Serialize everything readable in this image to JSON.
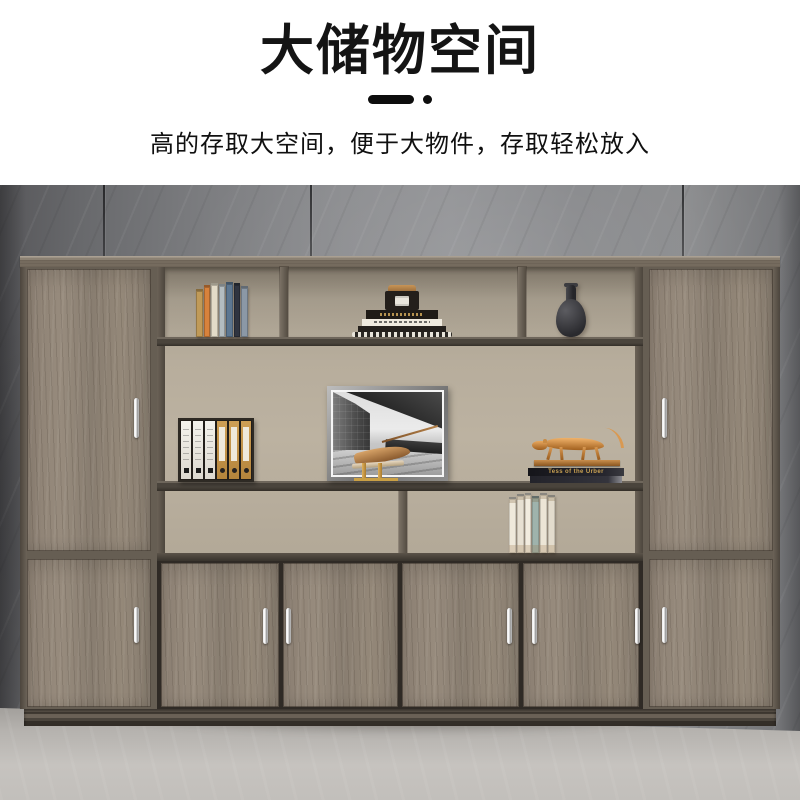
{
  "header": {
    "title": "大储物空间",
    "subtitle": "高的存取大空间，便于大物件，存取轻松放入"
  },
  "scene": {
    "leopard_book_label": "Tess of the Urber",
    "decor_items": [
      "standing-books",
      "book-stack-with-candle-jar",
      "ceramic-vase",
      "file-binders",
      "framed-architecture-photo",
      "wooden-bird-sculpture",
      "copper-leopard-statue",
      "white-book-row"
    ],
    "books_top": [
      "#c09a58",
      "#d8823c",
      "#e3dbc8",
      "#b3bcc0",
      "#5d7791",
      "#2f3440",
      "#8b98a6"
    ],
    "books_bottom": [
      "#efe9db",
      "#e7e0d2",
      "#f2ecdf",
      "#9fb3ac",
      "#ece5d6",
      "#e3dccd"
    ],
    "binders": [
      "white",
      "white",
      "white",
      "tan",
      "tan",
      "tan"
    ],
    "colors": {
      "title_text": "#141414",
      "wall_gray": "#85868a",
      "floor_gray": "#c2bfbb",
      "wood_gray_walnut": "#8e8276",
      "hutch_back_beige": "#b7ad9c",
      "frame_dark_wood": "#3a352e",
      "handle_silver": "#e0e0e0",
      "statue_copper": "#c98f4d"
    }
  }
}
